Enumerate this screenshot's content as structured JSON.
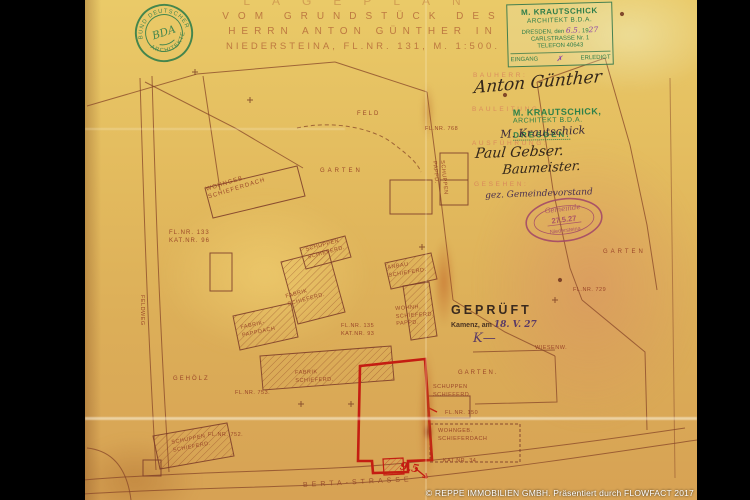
{
  "document": {
    "title": {
      "line1": "LAGEPLAN",
      "line2": "VOM GRUNDSTÜCK DES",
      "line3": "HERRN ANTON GÜNTHER IN",
      "line4": "NIEDERSTEINA, FL.NR. 131, M. 1:500."
    },
    "owner_form": {
      "bauherr_label": "BAUHERR:",
      "bauherr_signature": "Anton Günther",
      "bauleitung_label": "BAULEITUNG:",
      "bauleitung_signature": "M. Krautschick",
      "ausfuehrung_label": "AUSFÜHRUNG:",
      "ausfuehrung_signature_1": "Paul Gebser.",
      "ausfuehrung_signature_2": "Baumeister.",
      "gesehen_label": "GESEHEN:",
      "gesehen_note": "gez. Gemeindevorstand"
    },
    "stamps": {
      "bda_seal": {
        "ring_top": "BUND DEUTSCHER",
        "ring_bottom": "ARCHITEKTEN",
        "monogram": "BDA"
      },
      "office_stamp": {
        "line1": "M. KRAUTSCHICK",
        "line2": "ARCHITEKT B.D.A.",
        "line3_pre": "DRESDEN, den",
        "line3_hand": "6.5.",
        "line3_year": "19",
        "line3_year_hand": "27",
        "line4": "CARLSTRASSE Nr. 1",
        "line5": "TELEFON 40643",
        "footer_left": "EINGANG",
        "footer_mark": "✗",
        "footer_right": "ERLEDIGT"
      },
      "architect_stamp": {
        "line1": "M. KRAUTSCHICK,",
        "line2": "ARCHITEKT B.D.A.",
        "line3": "DRESDEN."
      },
      "geprueft_stamp": {
        "title": "GEPRÜFT",
        "place": "Kamenz, am",
        "date_hand": "18. V. 27",
        "initial_hand": "K—"
      },
      "gemeinde_seal": {
        "top": "Gemeinde",
        "center": "27.5.27",
        "bottom": "Niedersteina"
      }
    },
    "plan": {
      "street_label": "BERTA-STRASSE",
      "red_dimension": "9,5",
      "labels": [
        {
          "text": "FELD"
        },
        {
          "text": "FL.NR. 768"
        },
        {
          "text": "GARTEN"
        },
        {
          "text": "WOHNGEB.\nSCHIEFERDACH"
        },
        {
          "text": "FL.NR. 133\nKAT.NR. 96"
        },
        {
          "text": "SCHUPPEN\nSCHIEFERD."
        },
        {
          "text": "FABRIK\nSCHIEFERD."
        },
        {
          "text": "FABRIK-\nPAPPDACH"
        },
        {
          "text": "ANBAU\nSCHIEFERD."
        },
        {
          "text": "WOHNH.\nSCHIEFERD.\nPAPPD."
        },
        {
          "text": "FL.NR. 135\nKAT.NR. 93"
        },
        {
          "text": "FABRIK\nSCHIEFERD."
        },
        {
          "text": "FL.NR. 729"
        },
        {
          "text": "WIESENW."
        },
        {
          "text": "GARTEN."
        },
        {
          "text": "FL.NR. 150"
        },
        {
          "text": "SCHUPPEN\nSCHIEFERD."
        },
        {
          "text": "WOHNGEB.\nSCHIEFERDACH"
        },
        {
          "text": "KAT.NR. 34."
        },
        {
          "text": "GEHÖLZ"
        },
        {
          "text": "FL.NR. 753."
        },
        {
          "text": "FL.NR. 752."
        },
        {
          "text": "SCHUPPEN\nSCHIEFERD."
        },
        {
          "text": "GARTEN"
        },
        {
          "text": "FELDWEG"
        },
        {
          "text": "SCHUPPEN\nPAPPD."
        }
      ]
    }
  },
  "watermark": "© REPPE IMMOBILIEN GMBH. Präsentiert durch FLOWFACT 2017",
  "colors": {
    "paper": "#e0b45a",
    "plan_line": "#8a4a2e",
    "label_ink": "#943c24",
    "stamp_green": "#2e7d4a",
    "stamp_purple": "#a04468",
    "signature_ink": "#33261a",
    "highlight_red": "#cc1111",
    "watermark_white": "#ffffff"
  }
}
